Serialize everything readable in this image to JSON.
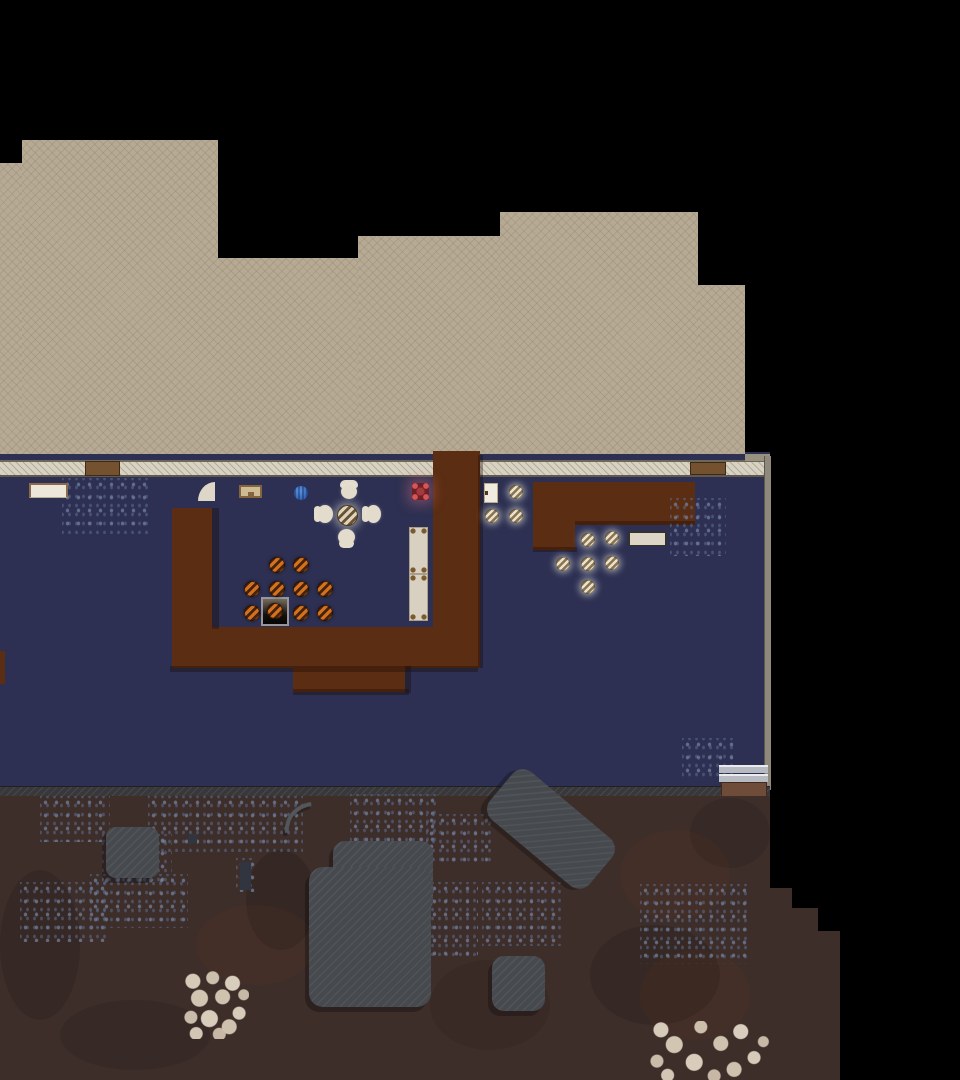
{
  "scene": {
    "title": "Top-down colony simulation map",
    "view": "revealed map section with sand terrain, a walled building interior and dark soil yard",
    "no_visible_text": true
  },
  "palette": {
    "unexplored": "#000000",
    "sand": "#b6aa95",
    "interior_floor": "#2d3052",
    "wall": "#d8d2c3",
    "wood_structure": "#5b2d13",
    "soil": "#3e2e2a",
    "rock": "#46494d",
    "meal_orange": "#d2711f",
    "meal_plated": "#e9e1ce",
    "brazier_red": "#d4555a",
    "ball_blue": "#4a7fd4",
    "stone_chunks": "#d2c5b2"
  },
  "labels": {
    "sand": "Revealed sand terrain",
    "floor": "Building interior floor",
    "wall": "Stone wall",
    "wall_bottom": "Dark stone wall",
    "wall_right": "Right wall",
    "wooden_door": "Wooden door",
    "white_door": "Door",
    "door_arc": "Door swing arc",
    "shelf": "Shelf",
    "picture": "Wall decoration",
    "ball": "Blue sphere",
    "stool": "Stool",
    "dining_table": "Round dining table",
    "chair": "Chair",
    "brazier": "Brazier",
    "bed": "Bed",
    "stove": "Stove",
    "meal_orange": "Prepared meal",
    "meal_white": "Plated meal",
    "wood_structure": "Wooden structure",
    "crate": "Stacked crates",
    "dirt": "Dirt patch",
    "ground": "Dark soil terrain",
    "rock": "Rock formation",
    "stones": "Stone chunk pile",
    "unexplored": "Unexplored area"
  },
  "counts": {
    "orange_meals": 10,
    "plated_meals": 9,
    "beds": 2,
    "chairs_around_table": 3,
    "stools": 1,
    "doors": 4,
    "rock_formations": 4,
    "stone_piles": 2
  }
}
